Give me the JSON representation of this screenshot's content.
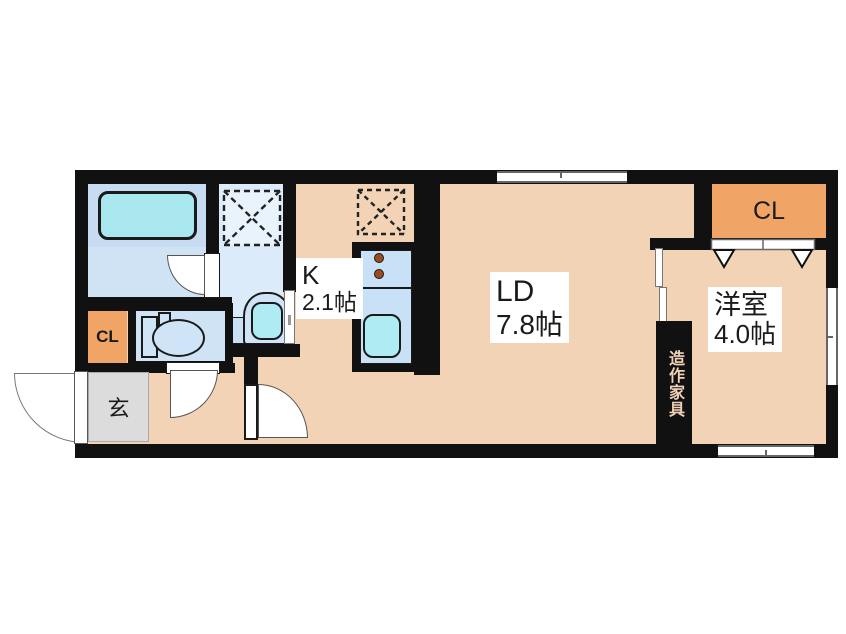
{
  "plan_title": "1LDK floor plan",
  "rooms": {
    "living_dining": {
      "label": "LD",
      "size": "7.8帖"
    },
    "kitchen": {
      "label": "K",
      "size": "2.1帖"
    },
    "bedroom": {
      "label": "洋室",
      "size": "4.0帖"
    },
    "closet_right": {
      "label": "CL"
    },
    "closet_left": {
      "label": "CL"
    },
    "entrance": {
      "label": "玄"
    },
    "built_in_furniture": {
      "label": "造作家具"
    }
  },
  "colors": {
    "wall": "#111111",
    "floor": "#f2d3b6",
    "wet_area": "#dcebf9",
    "bathtub": "#a9e7ef",
    "fixture": "#cfe4f7",
    "sink": "#aeebf2",
    "closet": "#f0a566",
    "entrance_floor": "#dcdcdc",
    "background": "#ffffff"
  }
}
